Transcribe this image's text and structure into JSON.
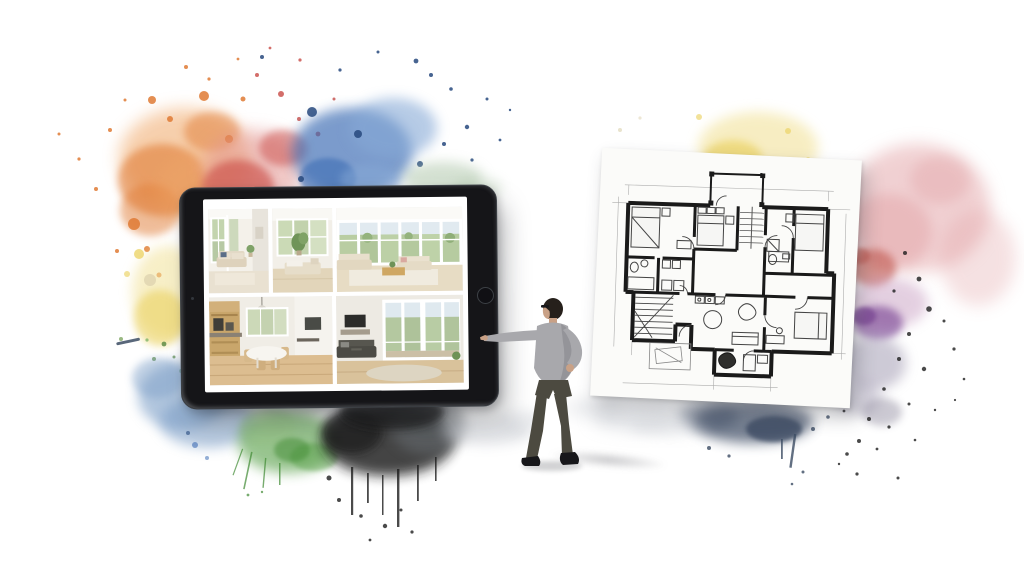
{
  "scene": {
    "title": "Real-estate watercolor collage",
    "description": "A miniature man points at a tablet displaying interior photos; beside him a hand-drawn apartment floor plan; both framed by rainbow watercolor splashes",
    "background": "#ffffff"
  },
  "palette": {
    "orange": "#e07b35",
    "orange_light": "#f0a96b",
    "red": "#c94a45",
    "red_light": "#e39894",
    "blue": "#3e6db4",
    "blue_light": "#86a9d6",
    "navy": "#27497e",
    "sage": "#a9c2a4",
    "yellow": "#e9cf56",
    "yellow_light": "#f2e29a",
    "beige_dot": "#dbd0ac",
    "green": "#5aa14b",
    "green_light": "#95c285",
    "green_deep": "#3f8a33",
    "black": "#1d1d1d",
    "gray": "#6b6f74",
    "sky_blue": "#7d9fc7",
    "rose": "#e2a3a6",
    "rose_deep": "#c25c52",
    "mauve": "#c9a0c3",
    "purple": "#7c4795",
    "lavender_gray": "#a59fb5",
    "gray_violet": "#8f8a9e",
    "ink": "#3c4c63",
    "mist": "#c2c6cd"
  },
  "tablet": {
    "frame_color": "#151518",
    "rim_color": "#5d6166",
    "screen_color": "#ffffff",
    "camera": "front-camera",
    "home_button": "home-button",
    "photos": [
      {
        "name": "living-room-sofa",
        "desc": "white living room with beige sofa and tall windows"
      },
      {
        "name": "lounge-with-plant",
        "desc": "bright lounge with chaise, throw and green plant"
      },
      {
        "name": "panorama-living",
        "desc": "sun-lit living room with full window wall, two sofas and coffee table"
      },
      {
        "name": "kitchen-dining",
        "desc": "wooden kitchen with dining table and chairs"
      },
      {
        "name": "living-terrace",
        "desc": "living room with dark sofa and glass doors to terrace"
      }
    ]
  },
  "person": {
    "desc": "man in gray sweater and glasses pointing at the tablet",
    "hair": "#26201b",
    "skin": "#c9a186",
    "shirt": "#a8a8ac",
    "shirt_shade": "#8e8e93",
    "pants": "#4c4a40",
    "shoes": "#17171a"
  },
  "floor_plan": {
    "desc": "hand-drawn architectural floor plan of an apartment with bedrooms, bathrooms, stairs and living room",
    "paper": "#fbfbf9",
    "ink": "#1a1a1a",
    "pencil": "#999999",
    "furniture_line": "#444444"
  }
}
